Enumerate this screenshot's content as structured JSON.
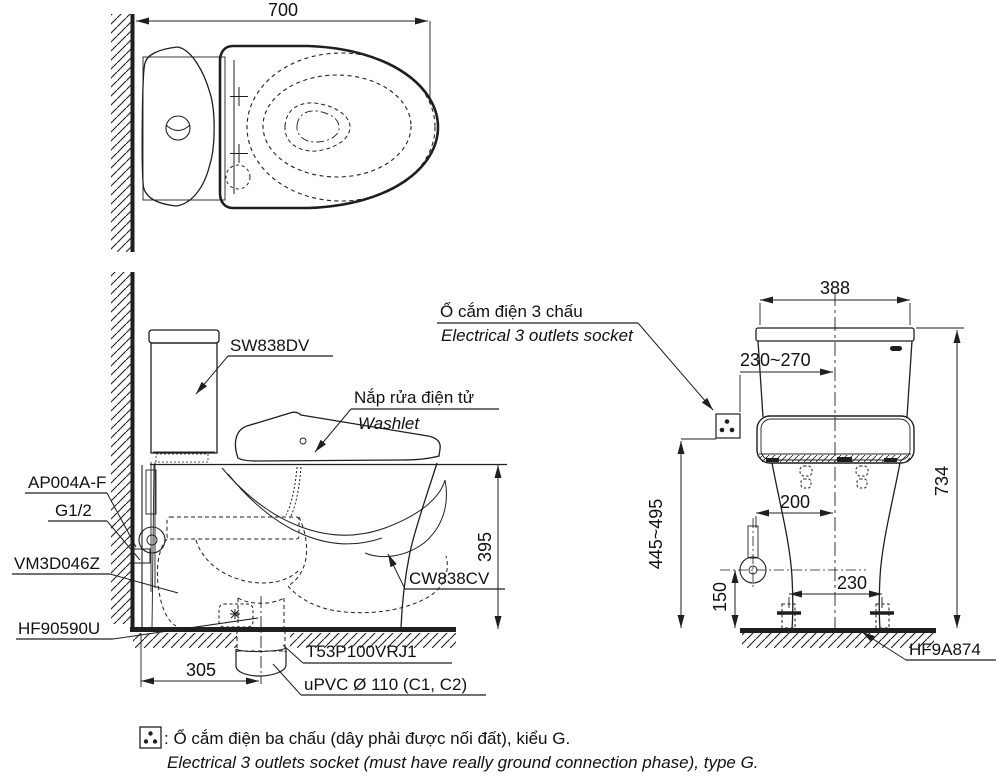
{
  "colors": {
    "line": "#1f1f1f",
    "text": "#111111"
  },
  "top_view": {
    "dim_width": "700"
  },
  "side_view": {
    "dim_height_rim": "395",
    "dim_rough_in": "305",
    "label_tank": "SW838DV",
    "label_washlet_vi": "Nắp rửa điện tử",
    "label_washlet_en": "Washlet",
    "label_supply": "AP004A-F",
    "label_thread": "G1/2",
    "label_valve": "VM3D046Z",
    "label_seal": "HF90590U",
    "label_bowl": "CW838CV",
    "label_flange": "T53P100VRJ1",
    "label_pipe": "uPVC Ø 110 (C1, C2)"
  },
  "front_view": {
    "label_socket_vi": "Ổ cắm điện 3 chấu",
    "label_socket_en": "Electrical 3 outlets socket",
    "dim_width": "388",
    "dim_socket_offset": "230~270",
    "dim_total_height": "734",
    "dim_socket_height": "445~495",
    "dim_supply_offset": "200",
    "dim_supply_height": "150",
    "dim_bolt_spacing": "230",
    "label_bolt": "HF9A874"
  },
  "footnote": {
    "vi": ": Ổ cắm điện ba chấu (dây phải được nối đất), kiểu G.",
    "en": "Electrical 3 outlets socket (must have really ground connection phase), type G."
  }
}
